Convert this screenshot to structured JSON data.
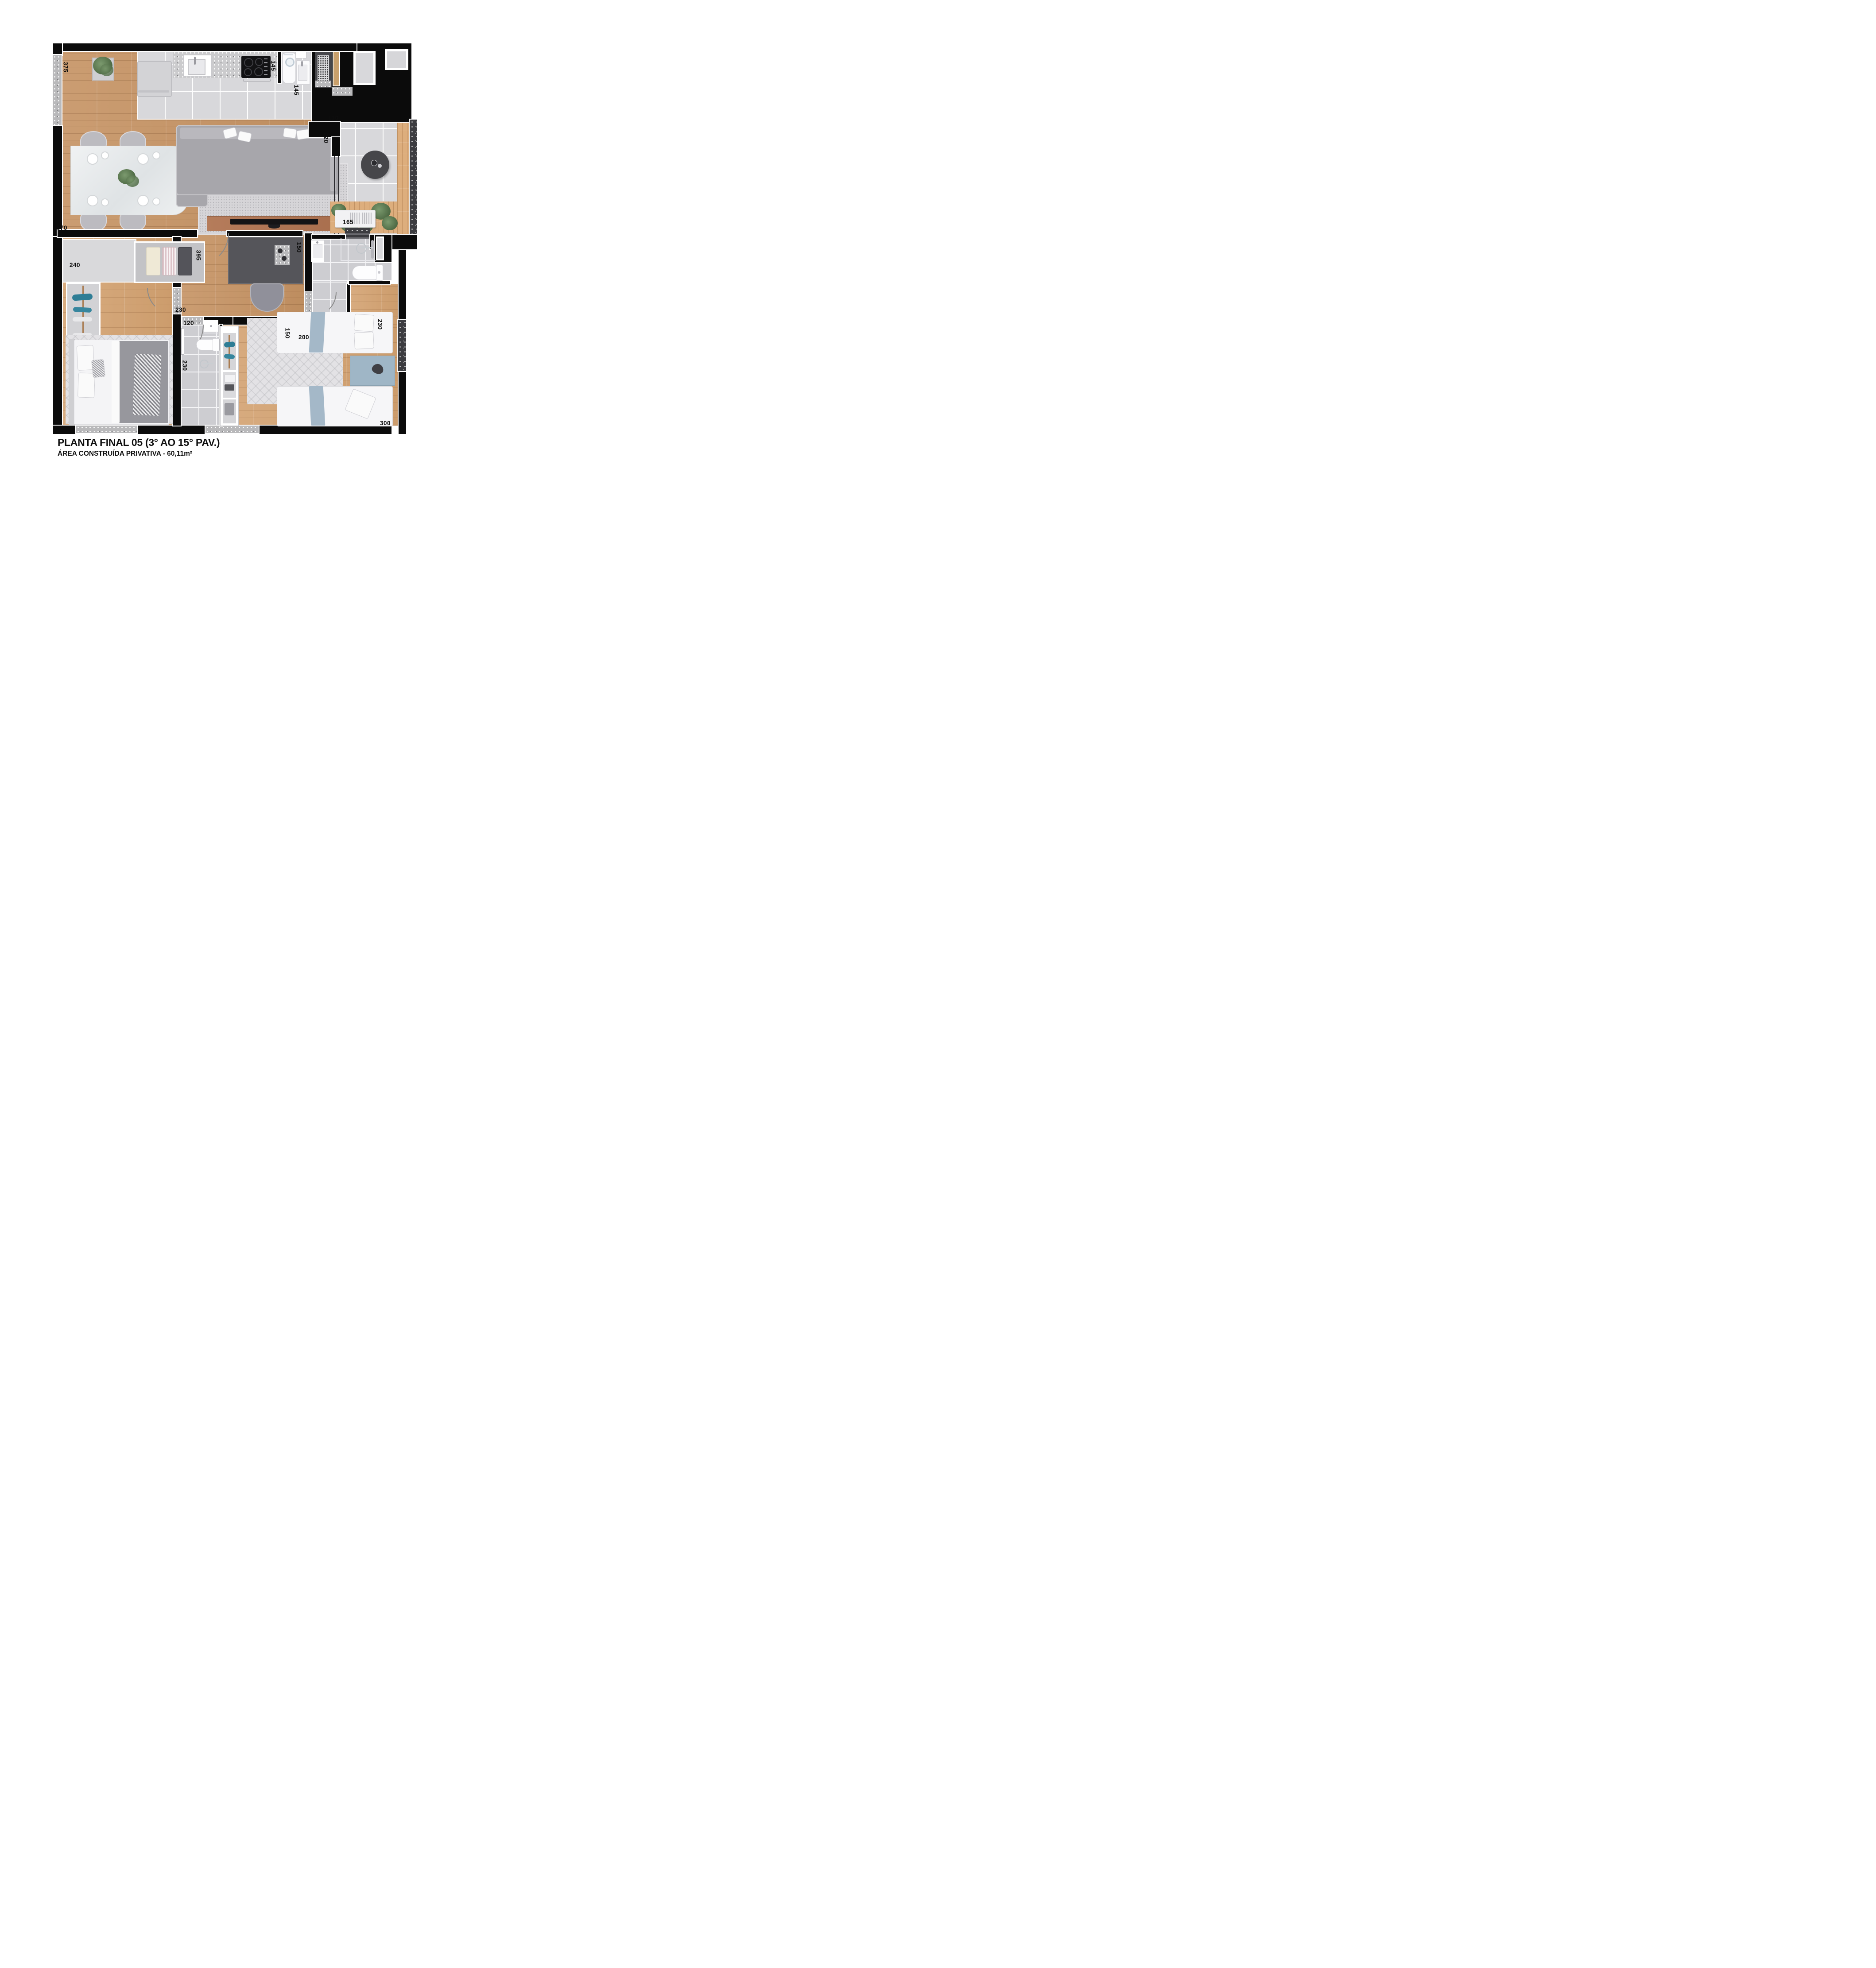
{
  "title": "PLANTA FINAL 05 (3° AO 15° PAV.)",
  "subtitle": "ÁREA CONSTRUÍDA PRIVATIVA - 60,11m²",
  "dimensions": {
    "living_window": "375",
    "kitchen_counter": "145",
    "service_width": "145",
    "balcony_wall": "110",
    "balcony_door": "220",
    "living_width": "570",
    "planter": "165",
    "bedroom1_width": "240",
    "wardrobe": "395",
    "bath1_wall": "150",
    "hall_width": "150",
    "hall_length": "200",
    "bedroom1_door": "230",
    "bedroom1_passage": "120",
    "bath2_width": "230",
    "bedroom2_width": "230",
    "bedroom2_length": "300"
  },
  "colors": {
    "wall": "#0b0b0b",
    "wood_living": "#c6986c",
    "wood_bedroom": "#d5a87c",
    "deck": "#ddae7d",
    "tile": "#d8d8db",
    "bath_tile": "#cdcdd1",
    "sofa_gray": "#a7a6ab",
    "desk_gray": "#55555a",
    "accent_blue": "#9fb6c6",
    "teal_decor": "#2e7d95",
    "plant_green": "#5d7a52"
  }
}
